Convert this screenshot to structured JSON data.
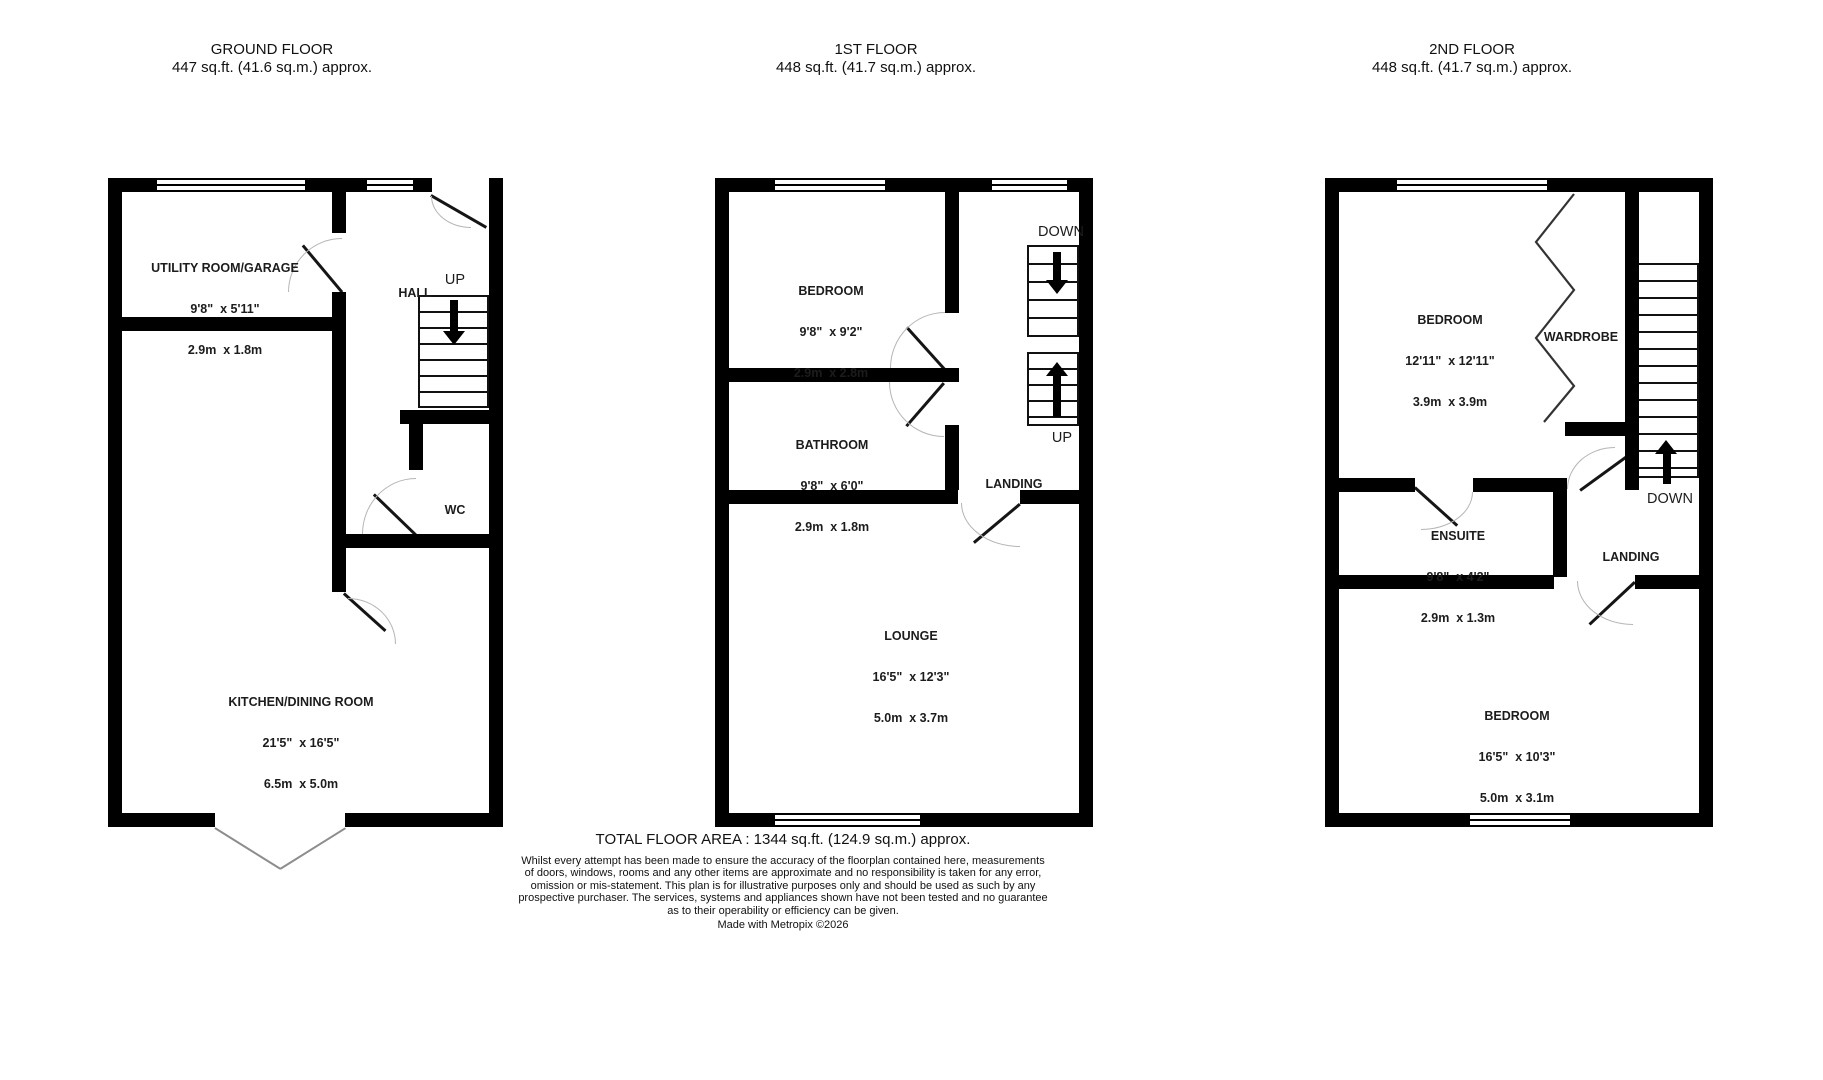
{
  "floors": [
    {
      "title": "GROUND FLOOR",
      "area": "447 sq.ft. (41.6 sq.m.) approx.",
      "rooms": {
        "utility": {
          "name": "UTILITY ROOM/GARAGE",
          "dim_ft": "9'8\"  x 5'11\"",
          "dim_m": "2.9m  x 1.8m"
        },
        "hall": {
          "name": "HALL"
        },
        "wc": {
          "name": "WC"
        },
        "kitchen": {
          "name": "KITCHEN/DINING ROOM",
          "dim_ft": "21'5\"  x 16'5\"",
          "dim_m": "6.5m  x 5.0m"
        }
      },
      "stairs": {
        "up": "UP"
      }
    },
    {
      "title": "1ST FLOOR",
      "area": "448 sq.ft. (41.7 sq.m.) approx.",
      "rooms": {
        "bedroom": {
          "name": "BEDROOM",
          "dim_ft": "9'8\"  x 9'2\"",
          "dim_m": "2.9m  x 2.8m"
        },
        "bathroom": {
          "name": "BATHROOM",
          "dim_ft": "9'8\"  x 6'0\"",
          "dim_m": "2.9m  x 1.8m"
        },
        "landing": {
          "name": "LANDING"
        },
        "lounge": {
          "name": "LOUNGE",
          "dim_ft": "16'5\"  x 12'3\"",
          "dim_m": "5.0m  x 3.7m"
        }
      },
      "stairs": {
        "down": "DOWN",
        "up": "UP"
      }
    },
    {
      "title": "2ND FLOOR",
      "area": "448 sq.ft. (41.7 sq.m.) approx.",
      "rooms": {
        "bedroom1": {
          "name": "BEDROOM",
          "dim_ft": "12'11\"  x 12'11\"",
          "dim_m": "3.9m  x 3.9m"
        },
        "wardrobe": {
          "name": "WARDROBE"
        },
        "ensuite": {
          "name": "ENSUITE",
          "dim_ft": "9'8\"  x 4'2\"",
          "dim_m": "2.9m  x 1.3m"
        },
        "landing": {
          "name": "LANDING"
        },
        "bedroom2": {
          "name": "BEDROOM",
          "dim_ft": "16'5\"  x 10'3\"",
          "dim_m": "5.0m  x 3.1m"
        }
      },
      "stairs": {
        "down": "DOWN"
      }
    }
  ],
  "footer": {
    "total": "TOTAL FLOOR AREA : 1344 sq.ft. (124.9 sq.m.) approx.",
    "disclaimer_lines": [
      "Whilst every attempt has been made to ensure the accuracy of the floorplan contained here, measurements",
      "of doors, windows, rooms and any other items are approximate and no responsibility is taken for any error,",
      "omission or mis-statement. This plan is for illustrative purposes only and should be used as such by any",
      "prospective purchaser. The services, systems and appliances shown have not been tested and no guarantee",
      "as to their operability or efficiency can be given."
    ],
    "credit": "Made with Metropix ©2026"
  },
  "colors": {
    "wall": "#000000",
    "text": "#1a1a1a",
    "door_arc": "#b5b5b5",
    "background": "#ffffff"
  }
}
